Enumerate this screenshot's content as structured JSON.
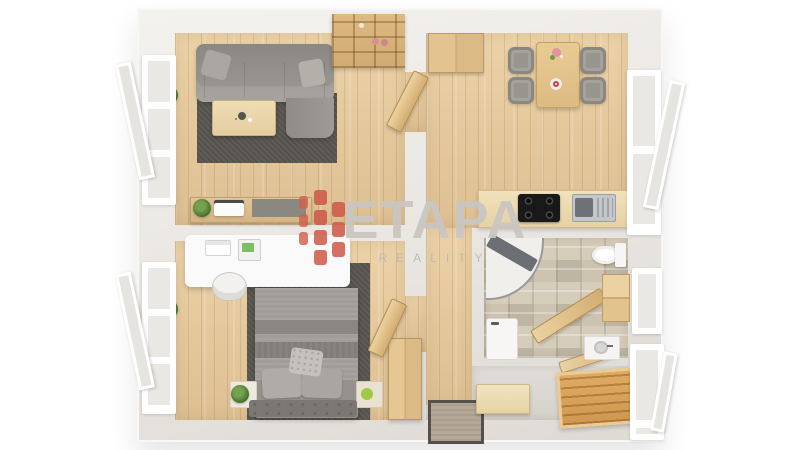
{
  "watermark": {
    "brand": "ETAPA",
    "tagline": "REALITY",
    "logo_brick_color": "#cc5342",
    "text_color": "#c9c6c2"
  },
  "scene": {
    "type": "3d-floor-plan-top-view",
    "rooms": [
      {
        "name": "living-room",
        "items": [
          "corner-sofa",
          "area-rug",
          "coffee-table",
          "wall-shelf",
          "sideboard",
          "tv",
          "potted-plant",
          "window"
        ]
      },
      {
        "name": "kitchen-dining",
        "items": [
          "dining-table",
          "dining-chair",
          "dining-chair",
          "dining-chair",
          "dining-chair",
          "wardrobe",
          "kitchen-counter",
          "cooktop",
          "sink",
          "potted-plant",
          "window"
        ]
      },
      {
        "name": "bedroom",
        "items": [
          "double-bed",
          "area-rug",
          "desk",
          "office-chair",
          "laptop",
          "printer",
          "nightstand",
          "nightstand",
          "wardrobe",
          "potted-plant",
          "window"
        ]
      },
      {
        "name": "bathroom",
        "items": [
          "corner-shower",
          "toilet",
          "washing-machine",
          "vanity-sink",
          "wall-cabinet",
          "open-door",
          "window"
        ]
      },
      {
        "name": "entry-hall",
        "items": [
          "doormat",
          "storage-box",
          "shoe-bench",
          "open-door",
          "potted-plant",
          "window"
        ]
      },
      {
        "name": "corridor",
        "items": [
          "open-door",
          "open-door"
        ]
      }
    ]
  },
  "palette": {
    "background": "#ffffff",
    "wall": "#e9e6e1",
    "wood_floor": "#e3c59b",
    "tile_floor": "#cdc3b0",
    "hall_floor": "#dad6d1",
    "rug": "#55524c",
    "upholstery_gray": "#95918c",
    "counter_wood": "#ecd9ae",
    "cooktop_black": "#191919",
    "plant_green": "#3c6b27",
    "window_frame": "#ffffff",
    "accent_wood": "#cf9850"
  }
}
